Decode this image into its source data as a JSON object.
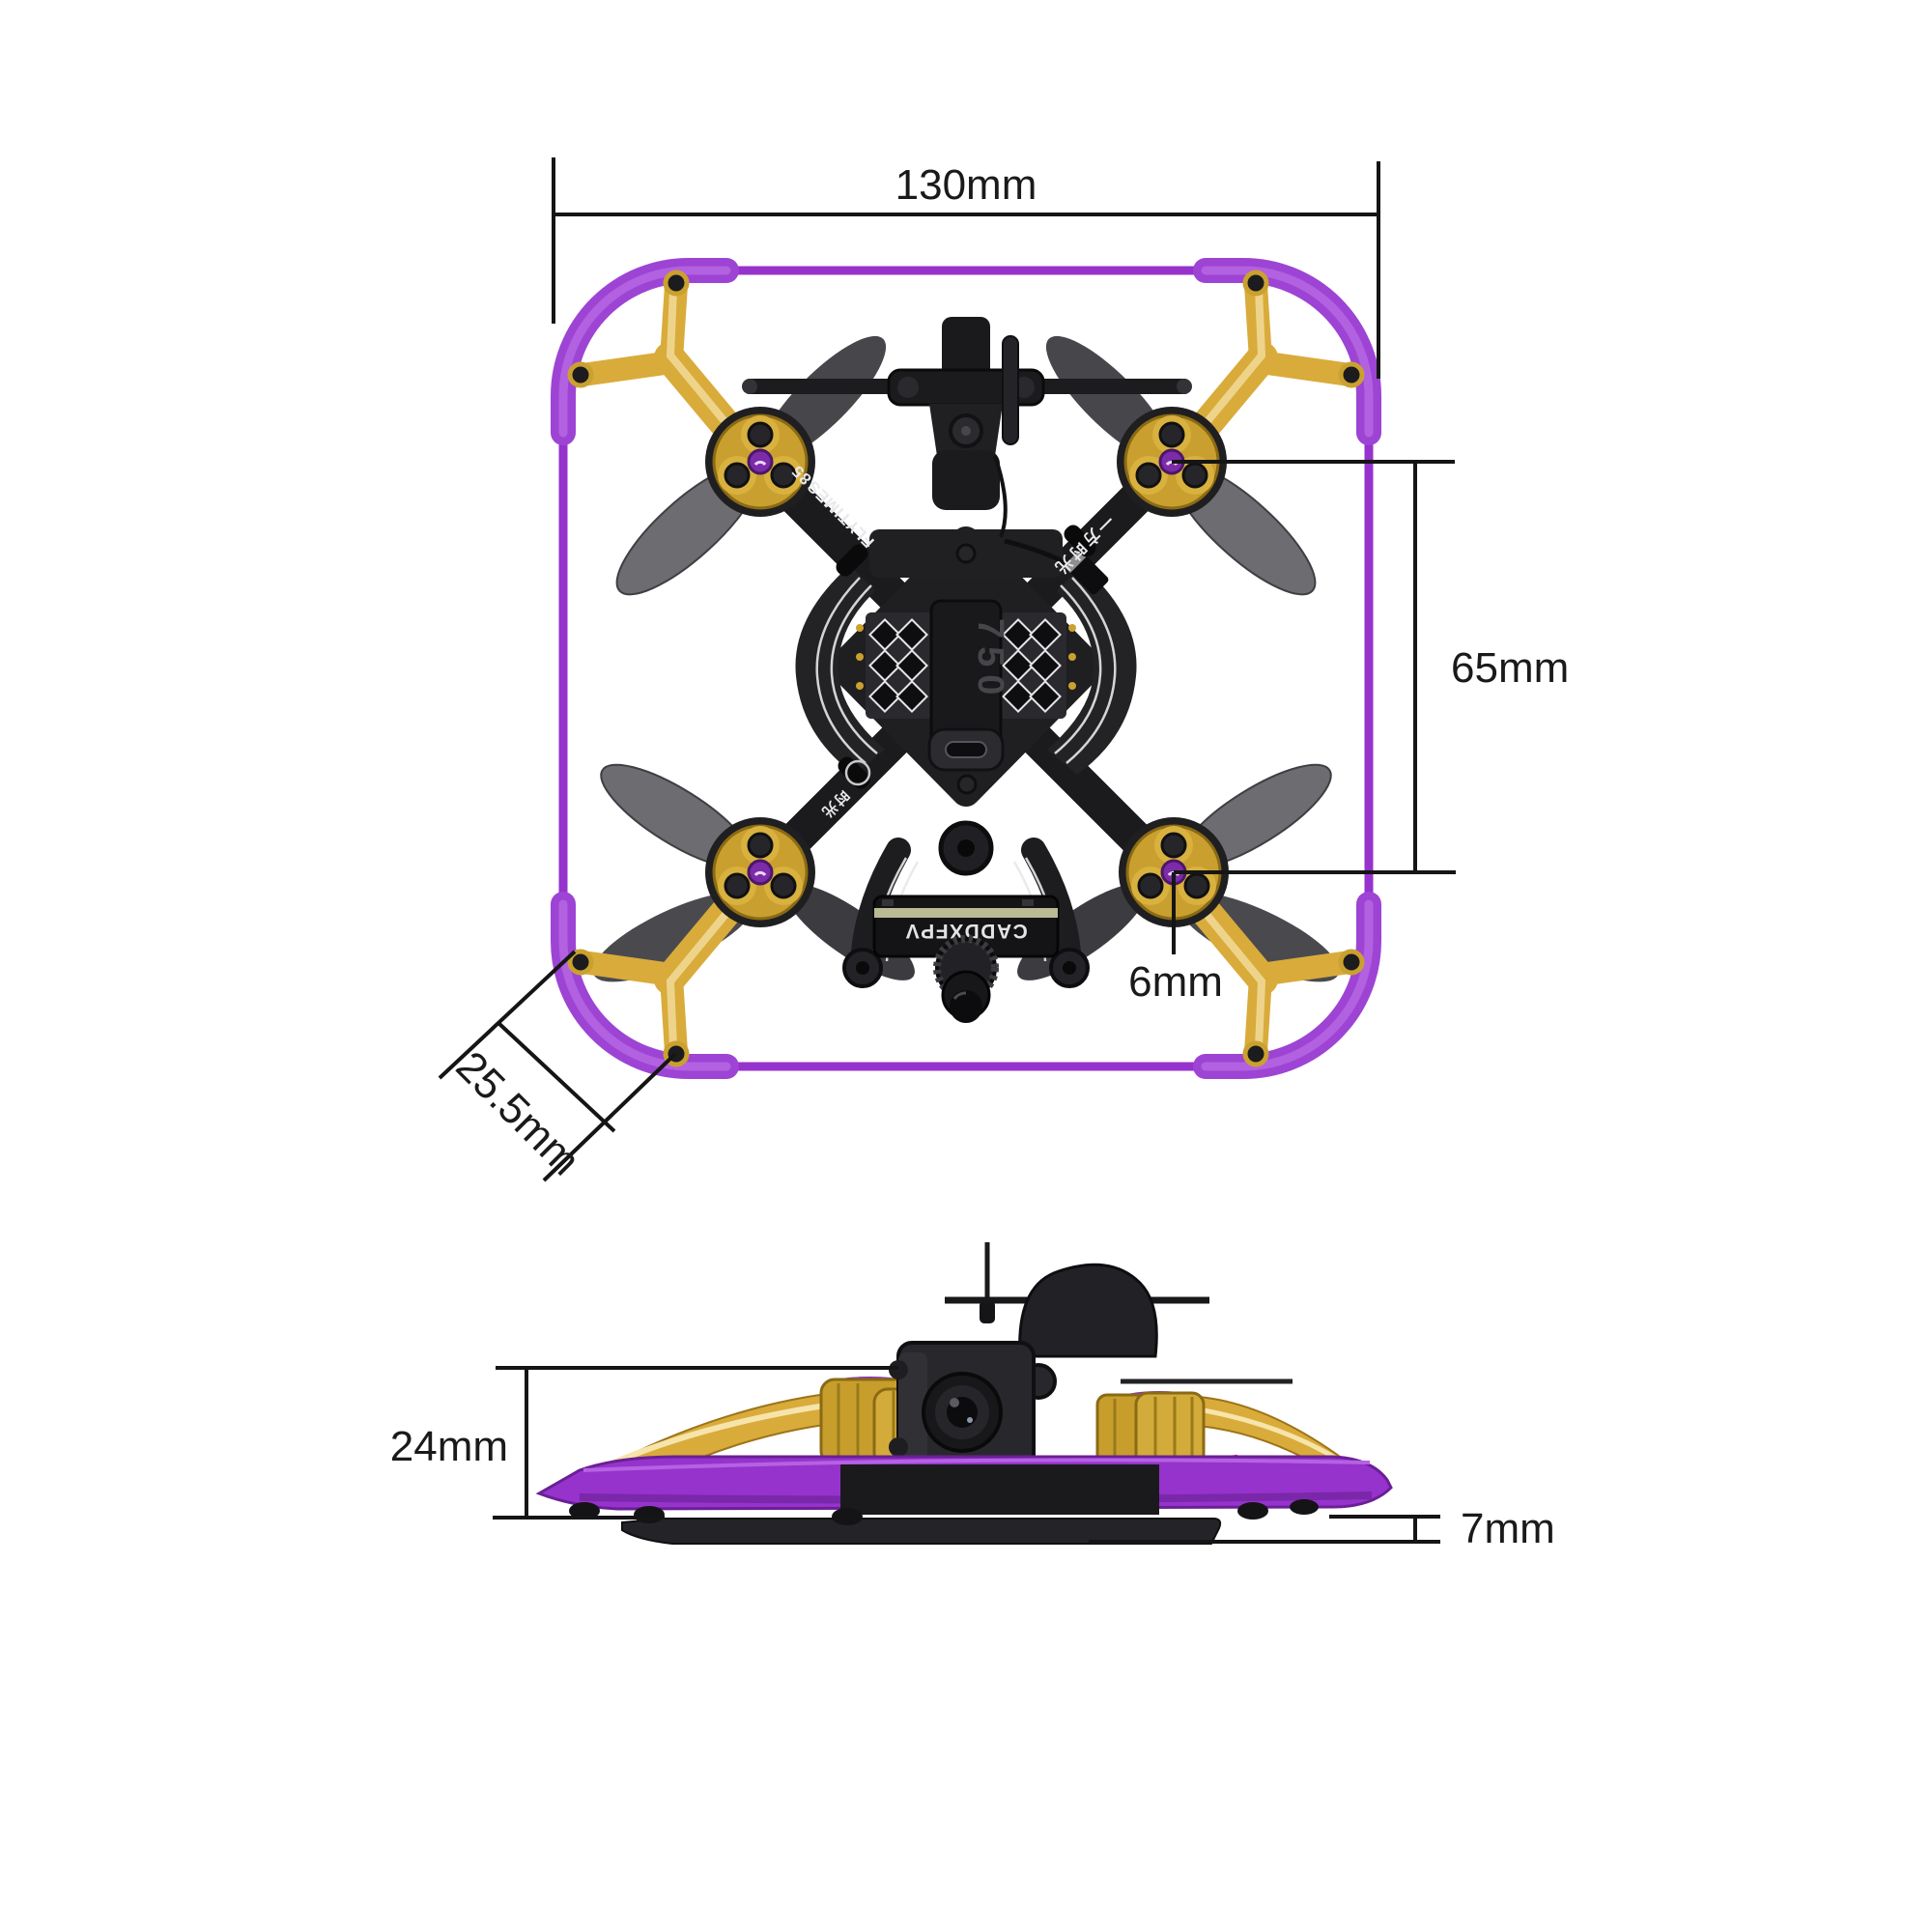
{
  "figure": {
    "type": "product-dimension-diagram",
    "subject": "FPV cinewhoop drone, top view and front view with measurements"
  },
  "colors": {
    "background": "#ffffff",
    "dimension_line": "#151515",
    "frame_purple": "#9633cc",
    "bumper_purple": "#9d44d4",
    "bracket_gold": "#d9ab3a",
    "motor_gold": "#c9a02f",
    "propeller_grey": "#6d6d71",
    "propeller_dark": "#47474b",
    "body_black": "#1d1d20",
    "camera_stripe_olive": "#c9c9a0",
    "accent_orange": "#e8872a",
    "hub_purple": "#7d2ba8"
  },
  "top_view": {
    "dimensions": {
      "overall_width": {
        "label": "130mm"
      },
      "motor_span_vertical": {
        "label": "65mm"
      },
      "prop_shaft_offset": {
        "label": "6mm"
      },
      "corner_section": {
        "label": "25.5mm"
      }
    },
    "markings": {
      "arm_brand": "FLYTIMES",
      "arm_model": "85",
      "arm_slogan_right": "一方时光",
      "arm_slogan_left": "时光",
      "battery_strap": "750",
      "camera_label": "CADDXFPV"
    }
  },
  "front_view": {
    "dimensions": {
      "overall_height": {
        "label": "24mm"
      },
      "bottom_clearance": {
        "label": "7mm"
      }
    }
  }
}
